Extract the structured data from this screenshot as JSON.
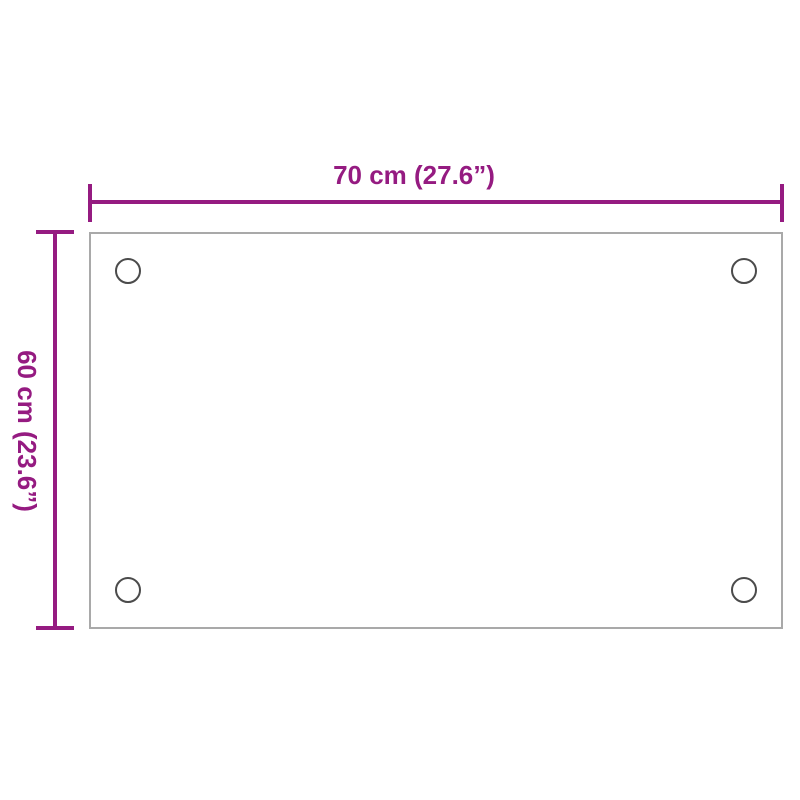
{
  "diagram": {
    "type": "product-dimension-diagram",
    "dimensions": {
      "width": {
        "label": "70 cm (27.6”)",
        "value_cm": 70,
        "value_inch": 27.6
      },
      "height": {
        "label": "60 cm (23.6”)",
        "value_cm": 60,
        "value_inch": 23.6
      }
    },
    "panel": {
      "shape": "rectangle",
      "mounting_holes": 4
    },
    "colors": {
      "dimension_accent": "#951b81",
      "panel_border": "#a9a9a9",
      "hole_outline": "#4b4b4b",
      "background": "#ffffff"
    }
  }
}
